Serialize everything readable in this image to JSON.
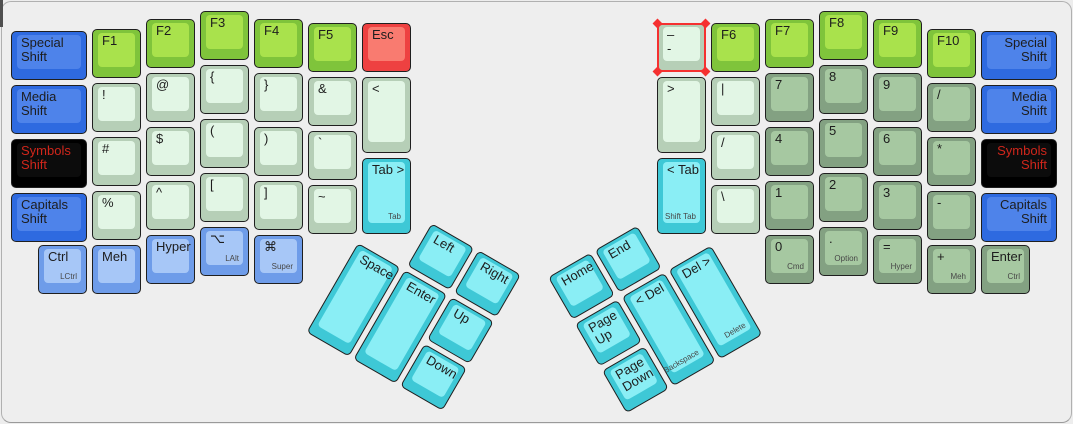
{
  "canvas": {
    "background": "#eeeeee",
    "border": "#b0b0b0",
    "selection_color": "#f53030"
  },
  "palette": {
    "green": {
      "base": "#7fc43b",
      "top": "#a9e24c"
    },
    "mint": {
      "base": "#b6cfb7",
      "top": "#e2f6e5"
    },
    "sage": {
      "base": "#83a182",
      "top": "#a6c8a1"
    },
    "blue": {
      "base": "#2e6ae0",
      "top": "#4e83ea"
    },
    "mod": {
      "base": "#6e9ce9",
      "top": "#a7c7f7"
    },
    "cyan": {
      "base": "#3ec8d6",
      "top": "#8aeef5"
    },
    "red": {
      "base": "#ee4141",
      "top": "#f97b70"
    },
    "black": {
      "base": "#000000",
      "top": "#0c0c0c",
      "text": "#d0261b"
    }
  },
  "groups": [
    {
      "name": "left-hand-keys",
      "x": 0,
      "y": 0,
      "r": 0,
      "keys": [
        {
          "id": "key-special-shift-left",
          "x": 11,
          "y": 31,
          "w": 76,
          "c": "blue",
          "l": [
            "Special",
            "Shift"
          ]
        },
        {
          "id": "key-media-shift-left",
          "x": 11,
          "y": 85,
          "w": 76,
          "c": "blue",
          "l": [
            "Media",
            "Shift"
          ]
        },
        {
          "id": "key-symbols-shift-left",
          "x": 11,
          "y": 139,
          "w": 76,
          "c": "black",
          "l": [
            "Symbols",
            "Shift"
          ]
        },
        {
          "id": "key-capitals-shift-left",
          "x": 11,
          "y": 193,
          "w": 76,
          "c": "blue",
          "l": [
            "Capitals",
            "Shift"
          ]
        },
        {
          "id": "key-f1",
          "x": 92,
          "y": 29,
          "c": "green",
          "l": [
            "F1"
          ]
        },
        {
          "id": "key-exclamation",
          "x": 92,
          "y": 83,
          "c": "mint",
          "l": [
            "!"
          ]
        },
        {
          "id": "key-hash",
          "x": 92,
          "y": 137,
          "c": "mint",
          "l": [
            "#"
          ]
        },
        {
          "id": "key-percent",
          "x": 92,
          "y": 191,
          "c": "mint",
          "l": [
            "%"
          ]
        },
        {
          "id": "key-f2",
          "x": 146,
          "y": 19,
          "c": "green",
          "l": [
            "F2"
          ]
        },
        {
          "id": "key-at",
          "x": 146,
          "y": 73,
          "c": "mint",
          "l": [
            "@"
          ]
        },
        {
          "id": "key-dollar",
          "x": 146,
          "y": 127,
          "c": "mint",
          "l": [
            "$"
          ]
        },
        {
          "id": "key-caret",
          "x": 146,
          "y": 181,
          "c": "mint",
          "l": [
            "^"
          ]
        },
        {
          "id": "key-f3",
          "x": 200,
          "y": 11,
          "c": "green",
          "l": [
            "F3"
          ]
        },
        {
          "id": "key-brace-open",
          "x": 200,
          "y": 65,
          "c": "mint",
          "l": [
            "{"
          ]
        },
        {
          "id": "key-paren-open",
          "x": 200,
          "y": 119,
          "c": "mint",
          "l": [
            "("
          ]
        },
        {
          "id": "key-bracket-open",
          "x": 200,
          "y": 173,
          "c": "mint",
          "l": [
            "["
          ]
        },
        {
          "id": "key-f4",
          "x": 254,
          "y": 19,
          "c": "green",
          "l": [
            "F4"
          ]
        },
        {
          "id": "key-brace-close",
          "x": 254,
          "y": 73,
          "c": "mint",
          "l": [
            "}"
          ]
        },
        {
          "id": "key-paren-close",
          "x": 254,
          "y": 127,
          "c": "mint",
          "l": [
            ")"
          ]
        },
        {
          "id": "key-bracket-close",
          "x": 254,
          "y": 181,
          "c": "mint",
          "l": [
            "]"
          ]
        },
        {
          "id": "key-f5",
          "x": 308,
          "y": 23,
          "c": "green",
          "l": [
            "F5"
          ]
        },
        {
          "id": "key-ampersand",
          "x": 308,
          "y": 77,
          "c": "mint",
          "l": [
            "&"
          ]
        },
        {
          "id": "key-backtick",
          "x": 308,
          "y": 131,
          "c": "mint",
          "l": [
            "`"
          ]
        },
        {
          "id": "key-tilde",
          "x": 308,
          "y": 185,
          "c": "mint",
          "l": [
            "~"
          ]
        },
        {
          "id": "key-esc",
          "x": 362,
          "y": 23,
          "c": "red",
          "l": [
            "Esc"
          ]
        },
        {
          "id": "key-less-than",
          "x": 362,
          "y": 77,
          "h": 76,
          "c": "mint",
          "l": [
            "<"
          ]
        },
        {
          "id": "key-tab-forward",
          "x": 362,
          "y": 158,
          "h": 76,
          "c": "cyan",
          "l": [
            "Tab >"
          ],
          "sub": "Tab"
        },
        {
          "id": "key-ctrl-left",
          "x": 38,
          "y": 245,
          "c": "mod",
          "l": [
            "Ctrl"
          ],
          "sub": "LCtrl"
        },
        {
          "id": "key-meh-left",
          "x": 92,
          "y": 245,
          "c": "mod",
          "l": [
            "Meh"
          ]
        },
        {
          "id": "key-hyper-left",
          "x": 146,
          "y": 235,
          "c": "mod",
          "l": [
            "Hyper"
          ]
        },
        {
          "id": "key-lalt",
          "x": 200,
          "y": 227,
          "c": "mod",
          "l": [
            "⌥"
          ],
          "sub": "LAlt"
        },
        {
          "id": "key-super",
          "x": 254,
          "y": 235,
          "c": "mod",
          "l": [
            "⌘"
          ],
          "sub": "Super"
        }
      ]
    },
    {
      "name": "right-hand-keys",
      "x": 0,
      "y": 0,
      "r": 0,
      "keys": [
        {
          "id": "key-dash-selected",
          "x": 657,
          "y": 23,
          "c": "mint",
          "l": [
            "–",
            "-"
          ],
          "sel": true
        },
        {
          "id": "key-greater-than",
          "x": 657,
          "y": 77,
          "h": 76,
          "c": "mint",
          "l": [
            ">"
          ]
        },
        {
          "id": "key-tab-back",
          "x": 657,
          "y": 158,
          "h": 76,
          "c": "cyan",
          "l": [
            "< Tab"
          ],
          "sub": "Shift Tab"
        },
        {
          "id": "key-f6",
          "x": 711,
          "y": 23,
          "c": "green",
          "l": [
            "F6"
          ]
        },
        {
          "id": "key-pipe",
          "x": 711,
          "y": 77,
          "c": "mint",
          "l": [
            "|"
          ]
        },
        {
          "id": "key-slash-f6",
          "x": 711,
          "y": 131,
          "c": "mint",
          "l": [
            "/"
          ]
        },
        {
          "id": "key-backslash",
          "x": 711,
          "y": 185,
          "c": "mint",
          "l": [
            "\\"
          ]
        },
        {
          "id": "key-f7",
          "x": 765,
          "y": 19,
          "c": "green",
          "l": [
            "F7"
          ]
        },
        {
          "id": "key-7",
          "x": 765,
          "y": 73,
          "c": "sage",
          "l": [
            "7"
          ]
        },
        {
          "id": "key-4",
          "x": 765,
          "y": 127,
          "c": "sage",
          "l": [
            "4"
          ]
        },
        {
          "id": "key-1",
          "x": 765,
          "y": 181,
          "c": "sage",
          "l": [
            "1"
          ]
        },
        {
          "id": "key-f8",
          "x": 819,
          "y": 11,
          "c": "green",
          "l": [
            "F8"
          ]
        },
        {
          "id": "key-8",
          "x": 819,
          "y": 65,
          "c": "sage",
          "l": [
            "8"
          ]
        },
        {
          "id": "key-5",
          "x": 819,
          "y": 119,
          "c": "sage",
          "l": [
            "5"
          ]
        },
        {
          "id": "key-2",
          "x": 819,
          "y": 173,
          "c": "sage",
          "l": [
            "2"
          ]
        },
        {
          "id": "key-f9",
          "x": 873,
          "y": 19,
          "c": "green",
          "l": [
            "F9"
          ]
        },
        {
          "id": "key-9",
          "x": 873,
          "y": 73,
          "c": "sage",
          "l": [
            "9"
          ]
        },
        {
          "id": "key-6",
          "x": 873,
          "y": 127,
          "c": "sage",
          "l": [
            "6"
          ]
        },
        {
          "id": "key-3",
          "x": 873,
          "y": 181,
          "c": "sage",
          "l": [
            "3"
          ]
        },
        {
          "id": "key-f10",
          "x": 927,
          "y": 29,
          "c": "green",
          "l": [
            "F10"
          ]
        },
        {
          "id": "key-slash-f10",
          "x": 927,
          "y": 83,
          "c": "sage",
          "l": [
            "/"
          ]
        },
        {
          "id": "key-asterisk",
          "x": 927,
          "y": 137,
          "c": "sage",
          "l": [
            "*"
          ]
        },
        {
          "id": "key-minus",
          "x": 927,
          "y": 191,
          "c": "sage",
          "l": [
            "-"
          ]
        },
        {
          "id": "key-special-shift-right",
          "x": 981,
          "y": 31,
          "w": 76,
          "c": "blue",
          "l": [
            "Special",
            "Shift"
          ],
          "a": "r"
        },
        {
          "id": "key-media-shift-right",
          "x": 981,
          "y": 85,
          "w": 76,
          "c": "blue",
          "l": [
            "Media",
            "Shift"
          ],
          "a": "r"
        },
        {
          "id": "key-symbols-shift-right",
          "x": 981,
          "y": 139,
          "w": 76,
          "c": "black",
          "l": [
            "Symbols",
            "Shift"
          ],
          "a": "r"
        },
        {
          "id": "key-capitals-shift-right",
          "x": 981,
          "y": 193,
          "w": 76,
          "c": "blue",
          "l": [
            "Capitals",
            "Shift"
          ],
          "a": "r"
        },
        {
          "id": "key-0",
          "x": 765,
          "y": 235,
          "c": "sage",
          "l": [
            "0"
          ],
          "sub": "Cmd"
        },
        {
          "id": "key-period",
          "x": 819,
          "y": 227,
          "c": "sage",
          "l": [
            "."
          ],
          "sub": "Option"
        },
        {
          "id": "key-equals",
          "x": 873,
          "y": 235,
          "c": "sage",
          "l": [
            "="
          ],
          "sub": "Hyper"
        },
        {
          "id": "key-plus",
          "x": 927,
          "y": 245,
          "c": "sage",
          "l": [
            "+"
          ],
          "sub": "Meh"
        },
        {
          "id": "key-enter-right",
          "x": 981,
          "y": 245,
          "c": "sage",
          "l": [
            "Enter"
          ],
          "sub": "Ctrl"
        }
      ]
    },
    {
      "name": "left-thumb-cluster",
      "x": 358,
      "y": 243,
      "r": 30,
      "keys": [
        {
          "id": "key-space",
          "x": 0,
          "y": 0,
          "h": 103,
          "c": "cyan",
          "l": [
            "Space"
          ]
        },
        {
          "id": "key-enter-thumb",
          "x": 54,
          "y": 0,
          "h": 103,
          "c": "cyan",
          "l": [
            "Enter"
          ]
        },
        {
          "id": "key-arrow-left",
          "x": 54,
          "y": -54,
          "c": "cyan",
          "l": [
            "Left"
          ]
        },
        {
          "id": "key-arrow-right",
          "x": 108,
          "y": -54,
          "c": "cyan",
          "l": [
            "Right"
          ]
        },
        {
          "id": "key-arrow-up",
          "x": 108,
          "y": 0,
          "c": "cyan",
          "l": [
            "Up"
          ]
        },
        {
          "id": "key-arrow-down",
          "x": 108,
          "y": 54,
          "c": "cyan",
          "l": [
            "Down"
          ]
        }
      ]
    },
    {
      "name": "right-thumb-cluster",
      "x": 575,
      "y": 324,
      "r": -30,
      "keys": [
        {
          "id": "key-home",
          "x": 0,
          "y": -54,
          "c": "cyan",
          "l": [
            "Home"
          ]
        },
        {
          "id": "key-end",
          "x": 54,
          "y": -54,
          "c": "cyan",
          "l": [
            "End"
          ]
        },
        {
          "id": "key-page-up",
          "x": 0,
          "y": 0,
          "c": "cyan",
          "l": [
            "Page",
            "Up"
          ]
        },
        {
          "id": "key-backspace",
          "x": 54,
          "y": 0,
          "h": 103,
          "c": "cyan",
          "l": [
            "< Del"
          ],
          "sub": "Backspace"
        },
        {
          "id": "key-delete",
          "x": 108,
          "y": 0,
          "h": 103,
          "c": "cyan",
          "l": [
            "Del >"
          ],
          "sub": "Delete"
        },
        {
          "id": "key-page-down",
          "x": 0,
          "y": 54,
          "c": "cyan",
          "l": [
            "Page",
            "Down"
          ]
        }
      ]
    }
  ]
}
